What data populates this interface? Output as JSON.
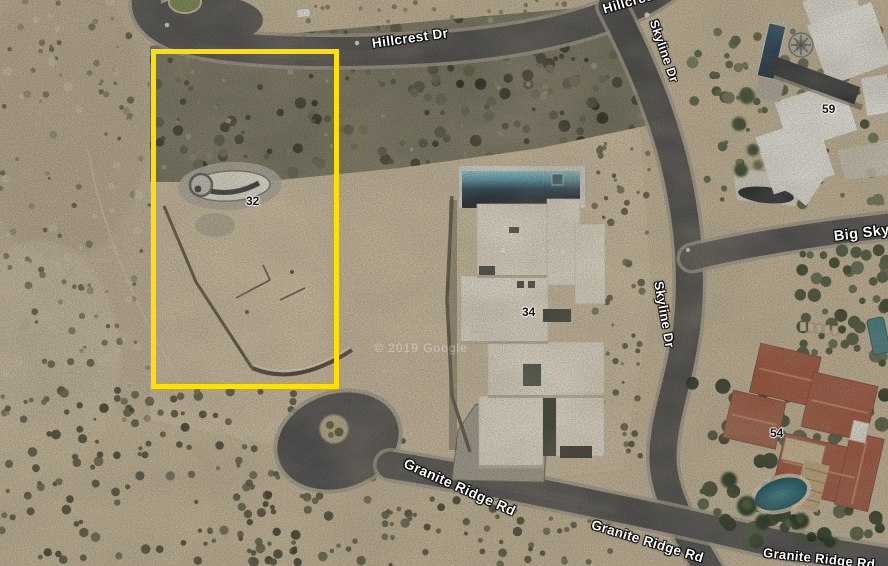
{
  "map": {
    "road_labels": [
      {
        "id": "hillcrest-main",
        "text": "Hillcrest Dr"
      },
      {
        "id": "hillcrest-clipped",
        "text": "Hillcrest Dr"
      },
      {
        "id": "skyline-upper",
        "text": "Skyline Dr"
      },
      {
        "id": "skyline-lower",
        "text": "Skyline Dr"
      },
      {
        "id": "big-sky",
        "text": "Big Sky"
      },
      {
        "id": "granite-ridge-west",
        "text": "Granite Ridge Rd"
      },
      {
        "id": "granite-ridge-mid",
        "text": "Granite Ridge Rd"
      },
      {
        "id": "granite-ridge-corner",
        "text": "Granite Ridge Rd"
      }
    ],
    "parcel_numbers": [
      {
        "id": "lot-32",
        "text": "32"
      },
      {
        "id": "lot-34",
        "text": "34"
      },
      {
        "id": "lot-54",
        "text": "54"
      },
      {
        "id": "lot-59",
        "text": "59"
      }
    ],
    "watermark_text": "© 2019 Google",
    "highlight_color": "#FFE000"
  }
}
